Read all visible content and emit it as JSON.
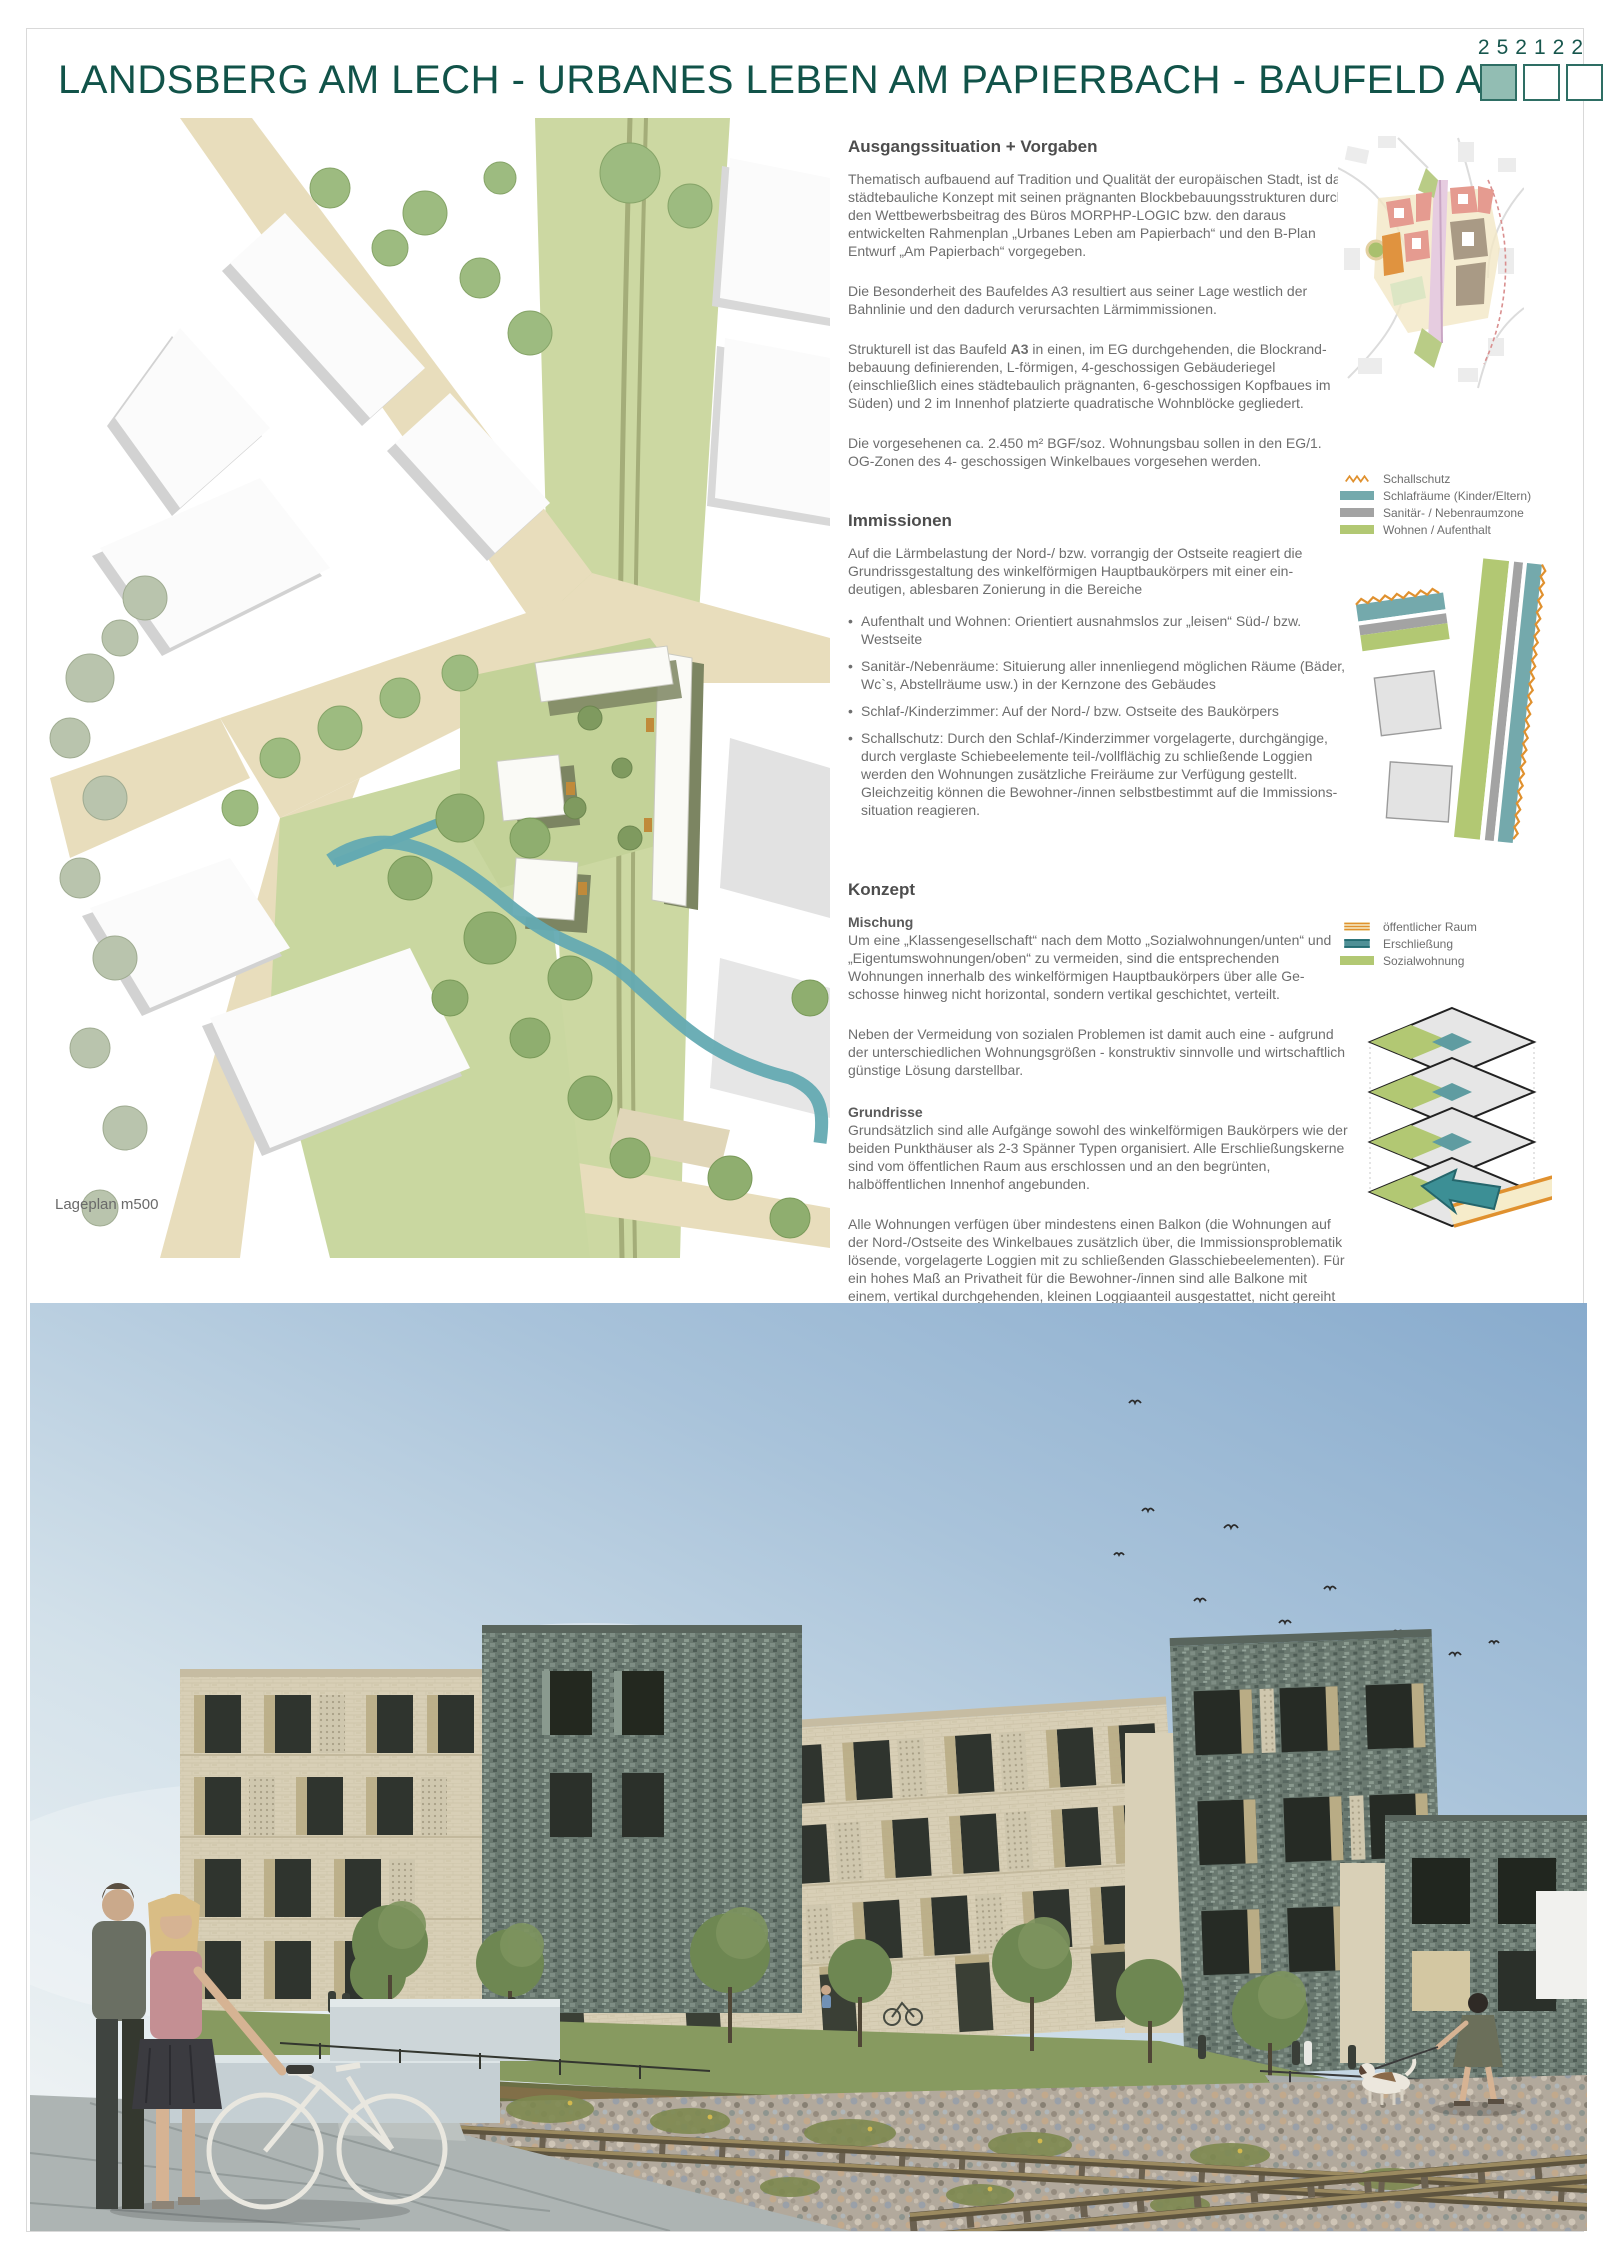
{
  "page": {
    "number": "252122",
    "title": "LANDSBERG AM LECH  -  URBANES LEBEN AM PAPIERBACH  -  BAUFELD  A3"
  },
  "colors": {
    "accent_teal": "#115349",
    "square_fill": "#92bdb3",
    "legend_orange": "#e0912f",
    "legend_teal": "#74a9ac",
    "legend_gray": "#a3a3a3",
    "legend_green": "#b2c873",
    "diagram_teal": "#3c8f95"
  },
  "siteplan": {
    "caption": "Lageplan  m500"
  },
  "sections": {
    "ausgang": {
      "heading": "Ausgangssituation + Vorgaben",
      "p1": "Thematisch aufbauend auf Tradition und Qualität der europäischen Stadt, ist das städtebauliche  Konzept mit seinen prägnanten Blockbebauungsstrukturen durch den Wettbewerbsbeitrag des Büros  MORPHP-LOGIC bzw. den daraus entwickelten Rahmenplan „Urbanes Leben am Papierbach“ und  den B-Plan Entwurf „Am Papierbach“ vorgegeben.",
      "p2": "Die Besonderheit des Baufeldes A3 resultiert aus seiner Lage westlich der Bahnlinie und den dadurch verursachten Lärmimmissionen.",
      "p3_pre": "Strukturell ist das Baufeld ",
      "p3_bold": "A3",
      "p3_post": " in einen, im EG durchgehenden, die Blockrand-bebauung definierenden, L-förmigen, 4-geschossigen Gebäuderiegel (einschließlich eines städtebaulich prägnanten, 6-geschossigen Kopfbaues im Süden) und 2 im Innenhof platzierte quadratische  Wohnblöcke gegliedert.",
      "p4": "Die vorgesehenen ca. 2.450 m² BGF/soz. Wohnungsbau sollen in den EG/1. OG-Zonen des 4- geschossigen Winkelbaues vorgesehen werden."
    },
    "immissionen": {
      "heading": "Immissionen",
      "intro": "Auf die Lärmbelastung der Nord-/ bzw. vorrangig der Ostseite reagiert die Grundrissgestaltung des  winkelförmigen Hauptbaukörpers mit einer ein-deutigen, ablesbaren Zonierung in die Bereiche",
      "b1": "Aufenthalt und Wohnen: Orientiert ausnahmslos zur „leisen“ Süd-/ bzw. Westseite",
      "b2": "Sanitär-/Nebenräume: Situierung aller innenliegend möglichen Räume (Bäder, Wc`s, Abstellräume usw.) in der Kernzone des Gebäudes",
      "b3": "Schlaf-/Kinderzimmer: Auf der Nord-/ bzw. Ostseite des Baukörpers",
      "b4": "Schallschutz: Durch den Schlaf-/Kinderzimmer vorgelagerte, durchgängige, durch verglaste Schiebeelemente teil-/vollflächig zu schließende Loggien werden den Wohnungen zusätzliche Freiräume zur Verfügung gestellt. Gleichzeitig können die Bewohner-/innen selbstbestimmt auf die Immissions-situation reagieren."
    },
    "konzept": {
      "heading": "Konzept",
      "mischung_label": "Mischung",
      "mischung_p1": "Um eine „Klassengesellschaft“ nach dem Motto „Sozialwohnungen/unten“ und „Eigentumswohnungen/oben“ zu vermeiden, sind die entsprechenden Wohnungen innerhalb des winkelförmigen  Hauptbaukörpers über alle Ge-schosse hinweg nicht horizontal, sondern vertikal geschichtet, verteilt.",
      "mischung_p2": "Neben der Vermeidung von sozialen Problemen ist damit auch eine - aufgrund der  unterschiedlichen Wohnungsgrößen - konstruktiv sinnvolle und wirtschaftlich günstige Lösung  darstellbar.",
      "grundrisse_label": "Grundrisse",
      "grundrisse_p1": "Grundsätzlich sind alle Aufgänge sowohl des winkelförmigen Baukörpers wie der beiden  Punkthäuser als 2-3 Spänner Typen organisiert. Alle Erschließungskerne sind vom öffentlichen  Raum aus erschlossen und an den begrünten, halböffentlichen Innenhof angebunden.",
      "grundrisse_p2": "Alle Wohnungen verfügen über mindestens einen Balkon (die Wohnungen auf der Nord-/Ostseite des Winkelbaues zusätzlich über, die Immissionsproblematik lösende, vorgelagerte Loggien mit zu schließenden Glasschiebeelementen). Für ein hohes Maß an Privatheit für die Bewohner-/innen sind alle Balkone mit einem, vertikal durchgehenden, kleinen Loggiaanteil ausgestattet, nicht  gereiht und entsprechend ihrer städtebaulichen und architektonischen Zuordnung ge-staltet und  dimensioniert (nach Außen ruhig und städtisch, zum Innenhof als großzügige Außenbereiche mit  direktem Bezug zum Garten)."
    }
  },
  "legend_immissionen": {
    "items": [
      {
        "label": "Schallschutz",
        "color": "#e0912f",
        "symbol": "zigzag"
      },
      {
        "label": "Schlafräume (Kinder/Eltern)",
        "color": "#74a9ac",
        "symbol": "bar"
      },
      {
        "label": "Sanitär- / Nebenraumzone",
        "color": "#a3a3a3",
        "symbol": "bar"
      },
      {
        "label": "Wohnen / Aufenthalt",
        "color": "#b2c873",
        "symbol": "bar"
      }
    ]
  },
  "legend_konzept": {
    "items": [
      {
        "label": "öffentlicher Raum",
        "color": "#e0912f",
        "symbol": "striped-bar"
      },
      {
        "label": "Erschließung",
        "color": "#2f8289",
        "symbol": "bar"
      },
      {
        "label": "Sozialwohnung",
        "color": "#b2c873",
        "symbol": "bar"
      }
    ]
  }
}
